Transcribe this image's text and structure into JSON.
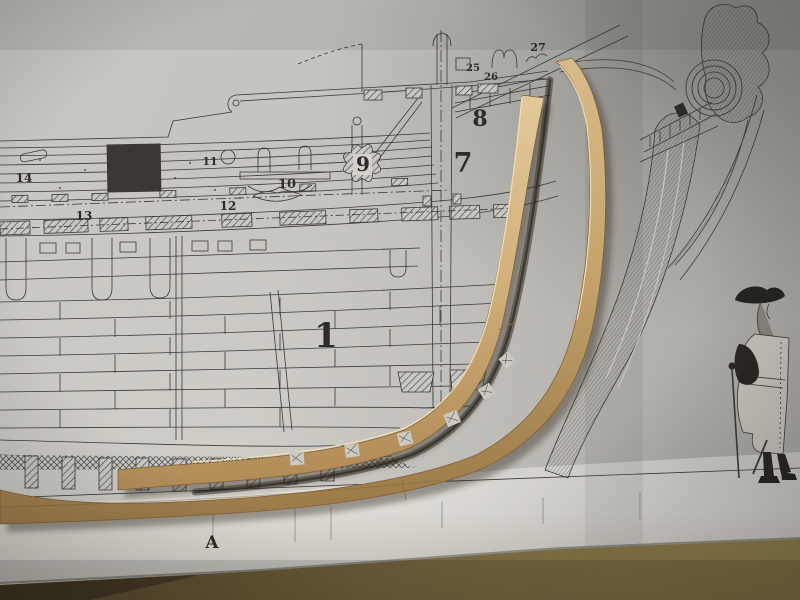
{
  "plan": {
    "labels": {
      "n1": "1",
      "n7": "7",
      "n8": "8",
      "n9": "9",
      "n10": "10",
      "n11": "11",
      "n12": "12",
      "n13": "13",
      "n14": "14",
      "n25": "25",
      "n26": "26",
      "n27": "27",
      "nA": "A"
    }
  },
  "colors": {
    "paper": "#c6c4be",
    "paper_bright": "#dbd9d3",
    "paper_shadow": "#aba9a3",
    "ink": "#3c3a36",
    "wood_light": "#e3cb9e",
    "wood_mid": "#cdab76",
    "wood_dark": "#a0説7a4e",
    "table_dark": "#55482c",
    "table_light": "#95834e",
    "black_patch": "#3b3734"
  }
}
